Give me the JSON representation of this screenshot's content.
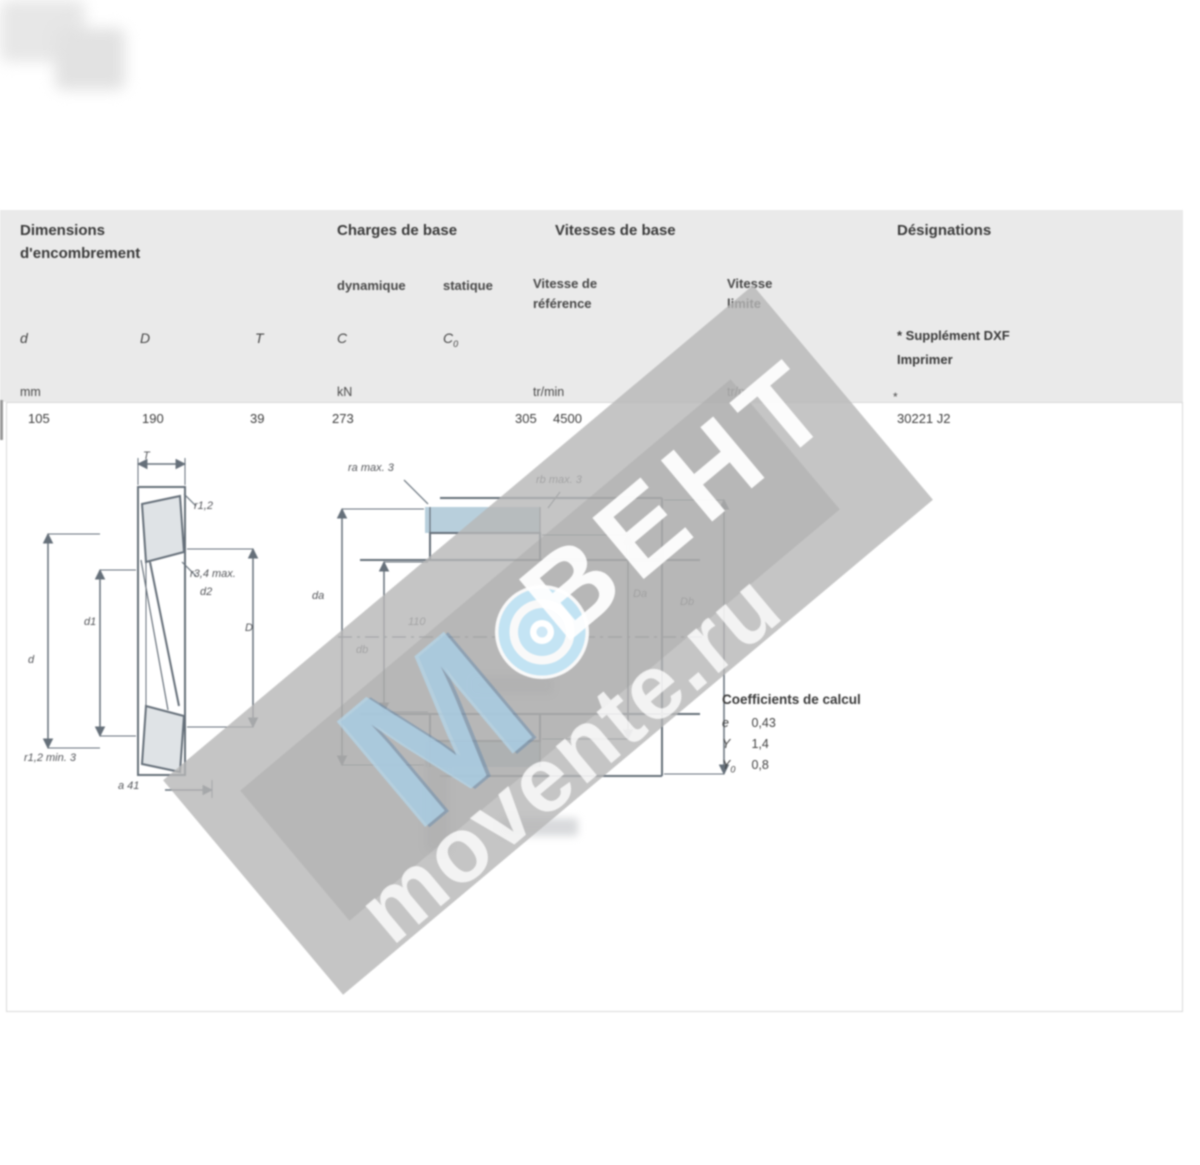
{
  "table": {
    "group_dimensions_line1": "Dimensions",
    "group_dimensions_line2": "d'encombrement",
    "group_loads": "Charges de base",
    "group_speeds": "Vitesses de base",
    "group_designation": "Désignations",
    "sub_dynamic": "dynamique",
    "sub_static": "statique",
    "sub_ref_line1": "Vitesse de",
    "sub_ref_line2": "référence",
    "sub_lim_line1": "Vitesse",
    "sub_lim_line2": "limite",
    "sym_d": "d",
    "sym_D": "D",
    "sym_T": "T",
    "sym_C": "C",
    "sym_C0_base": "C",
    "sym_C0_sub": "0",
    "designation_note_line1": "* Supplément DXF",
    "designation_note_line2": "Imprimer",
    "unit_mm": "mm",
    "unit_kn": "kN",
    "unit_rpm_ref": "tr/min",
    "unit_rpm_lim": "tr/min",
    "row": {
      "d": "105",
      "D": "190",
      "T": "39",
      "C": "273",
      "C0": "305",
      "v_ref": "4500",
      "footnote": "*",
      "designation": "30221 J2"
    }
  },
  "figure_left": {
    "dim_top": "T",
    "r12": "r1,2",
    "r34": "r3,4 max.",
    "d2": "d2",
    "d1": "d1",
    "d": "d",
    "D": "D",
    "a": "a 41",
    "note": "r1,2 min. 3"
  },
  "figure_mid": {
    "ra": "ra max. 3",
    "rb": "rb max. 3",
    "da": "da",
    "db": "db",
    "Da": "Da",
    "Db": "Db",
    "center": "110"
  },
  "factors": {
    "title": "Coefficients de calcul",
    "rows": [
      {
        "sym": "e",
        "sub": "",
        "val": "0,43"
      },
      {
        "sym": "Y",
        "sub": "",
        "val": "1,4"
      },
      {
        "sym": "Y",
        "sub": "0",
        "val": "0,8"
      }
    ]
  },
  "watermark": {
    "brand": "ВЕНТ",
    "site": "movente.ru"
  }
}
